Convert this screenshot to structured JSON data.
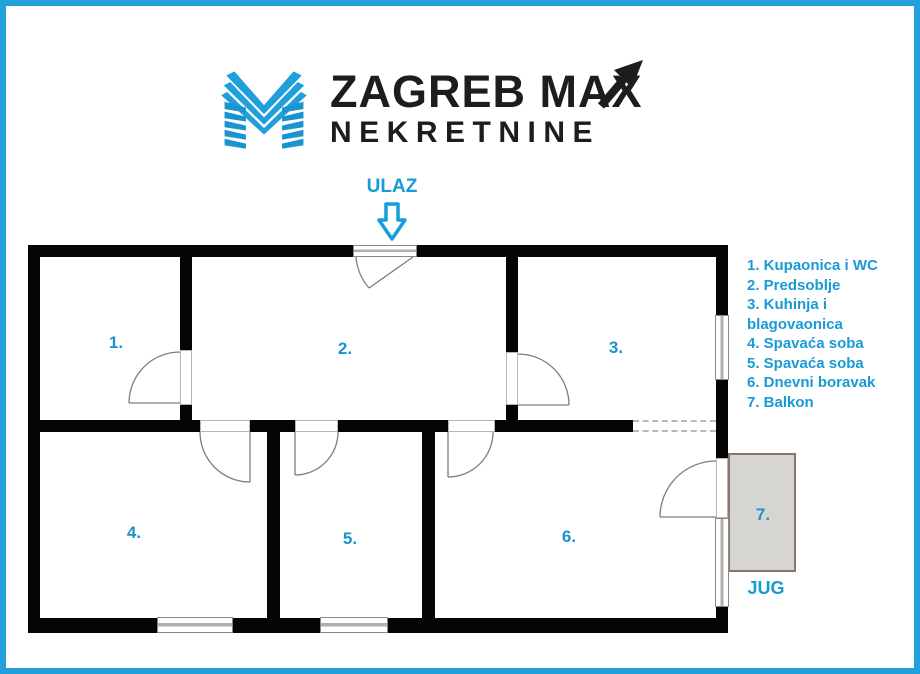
{
  "brand": {
    "line1": "ZAGREB MAX",
    "line2": "NEKRETNINE"
  },
  "plan": {
    "entrance_label": "ULAZ",
    "orientation_label": "JUG",
    "rooms": [
      {
        "plan_label": "1.",
        "legend_label": "1. Kupaonica i WC"
      },
      {
        "plan_label": "2.",
        "legend_label": "2. Predsoblje"
      },
      {
        "plan_label": "3.",
        "legend_label": "3. Kuhinja i blagovaonica"
      },
      {
        "plan_label": "4.",
        "legend_label": "4. Spavaća soba"
      },
      {
        "plan_label": "5.",
        "legend_label": "5. Spavaća soba"
      },
      {
        "plan_label": "6.",
        "legend_label": "6. Dnevni boravak"
      },
      {
        "plan_label": "7.",
        "legend_label": "7. Balkon"
      }
    ]
  },
  "icons": {
    "logo": "m-stripes-logo",
    "title_arrow": "trend-up-arrow",
    "entrance_arrow": "block-arrow-down"
  },
  "colors": {
    "accent_blue": "#189bd5",
    "frame_blue": "#22a0dc",
    "wall_black": "#050505",
    "balcony_fill": "#d7d5d2",
    "balcony_border": "#8d7569",
    "logo_text": "#1d1d1b"
  }
}
